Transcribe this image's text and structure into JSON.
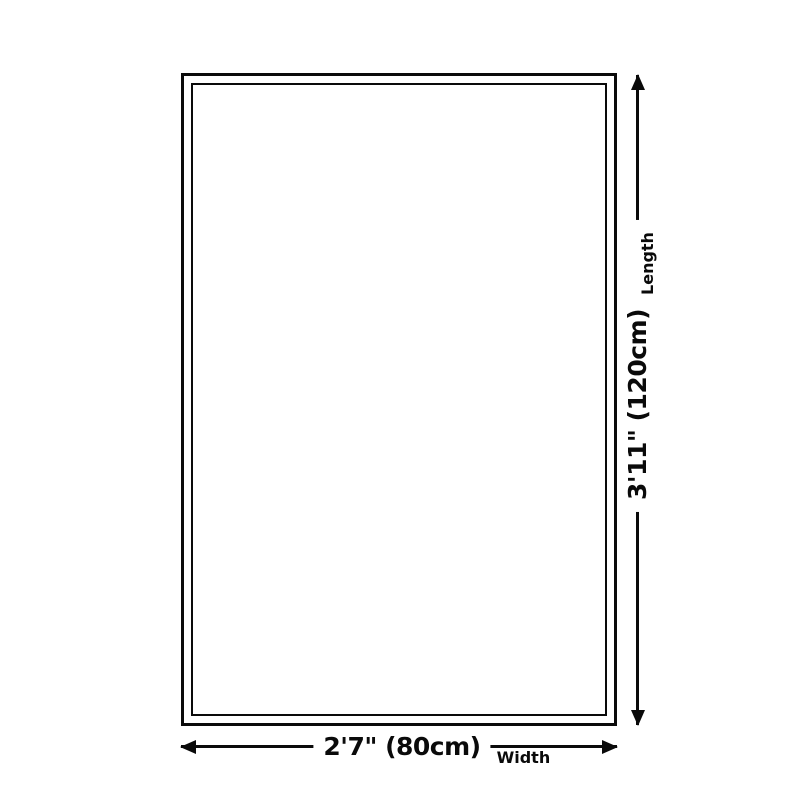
{
  "diagram": {
    "type": "product-size-diagram",
    "background_color": "#ffffff",
    "line_color": "#0a0a0a",
    "length": {
      "value": "3'11\" (120cm)",
      "label": "Length"
    },
    "width": {
      "value": "2'7\" (80cm)",
      "label": "Width"
    }
  }
}
